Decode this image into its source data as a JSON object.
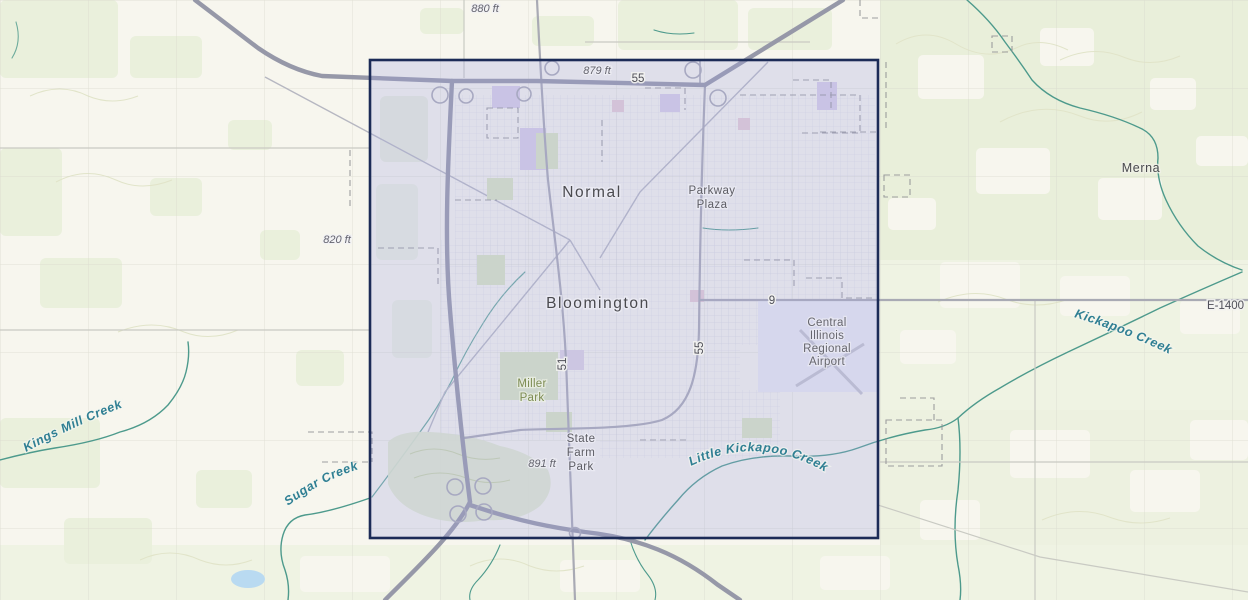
{
  "map": {
    "places": {
      "normal": "Normal",
      "bloomington": "Bloomington",
      "merna": "Merna",
      "parkway_plaza_line1": "Parkway",
      "parkway_plaza_line2": "Plaza",
      "airport_line1": "Central",
      "airport_line2": "Illinois",
      "airport_line3": "Regional",
      "airport_line4": "Airport",
      "miller_park_line1": "Miller",
      "miller_park_line2": "Park",
      "state_farm_park_line1": "State",
      "state_farm_park_line2": "Farm",
      "state_farm_park_line3": "Park"
    },
    "waterways": {
      "kings_mill_creek": "Kings Mill Creek",
      "sugar_creek": "Sugar Creek",
      "little_kickapoo_creek": "Little Kickapoo Creek",
      "kickapoo_creek": "Kickapoo Creek"
    },
    "elevations": {
      "spot_880": "880 ft",
      "spot_879": "879 ft",
      "spot_820": "820 ft",
      "spot_891": "891 ft"
    },
    "roads": {
      "i55_label": "55",
      "route55_vertical_label": "55",
      "route51_label": "51",
      "route9_label": "9",
      "e1400_label": "E-1400"
    },
    "colors": {
      "selection_border": "#1c2b57",
      "selection_fill": "rgba(160,165,226,0.28)",
      "creek": "#4d9a8c",
      "creek_label": "#2f7f93",
      "highway": "#9698a8",
      "map_background": "#f7f6ee",
      "vegetation": "#eaf0dc",
      "label_dark": "#4a4a4f"
    }
  }
}
